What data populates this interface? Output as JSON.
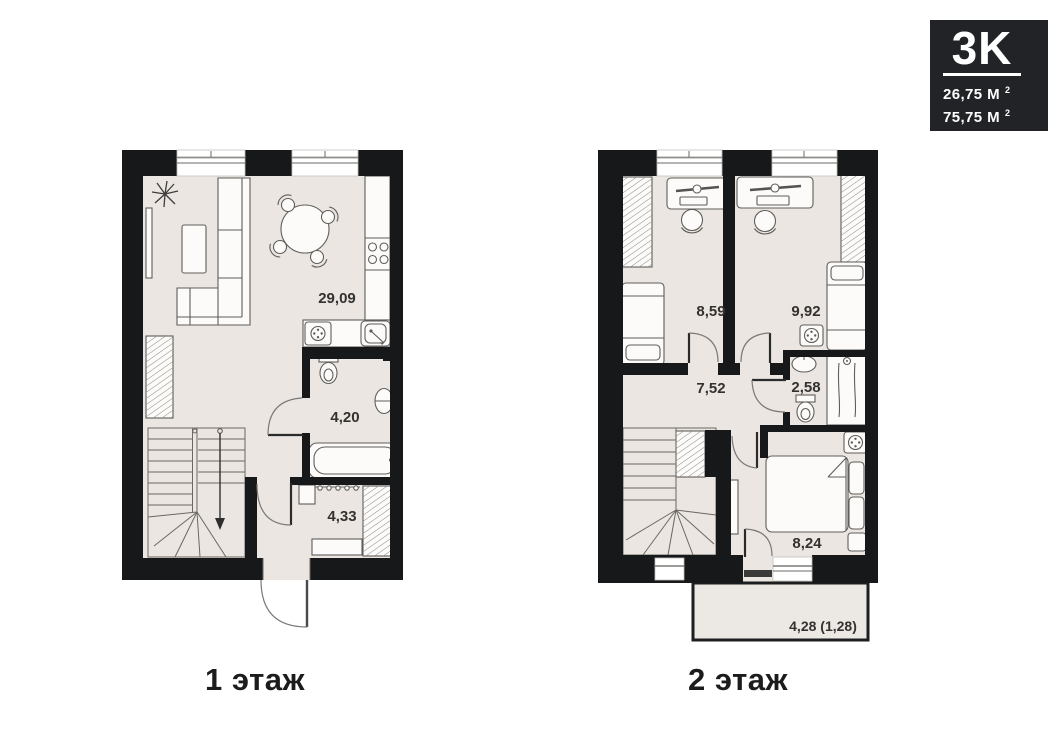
{
  "badge": {
    "type_label": "3K",
    "areas": [
      {
        "value": "26,75 М",
        "sup": "2"
      },
      {
        "value": "75,75 М",
        "sup": "2"
      }
    ]
  },
  "floors": [
    {
      "caption": "1 этаж",
      "rooms": [
        {
          "name": "kitchen-living-room",
          "area": "29,09"
        },
        {
          "name": "bathroom",
          "area": "4,20"
        },
        {
          "name": "hallway",
          "area": "4,33"
        }
      ]
    },
    {
      "caption": "2 этаж",
      "rooms": [
        {
          "name": "bedroom-1",
          "area": "8,59"
        },
        {
          "name": "bedroom-2",
          "area": "9,92"
        },
        {
          "name": "hall",
          "area": "7,52"
        },
        {
          "name": "bathroom",
          "area": "2,58"
        },
        {
          "name": "bedroom-3",
          "area": "8,24"
        },
        {
          "name": "balcony",
          "area": "4,28 (1,28)"
        }
      ]
    }
  ],
  "colors": {
    "wall": "#17181a",
    "floor_fill": "#ebe6e1",
    "badge_background": "#222326",
    "badge_text": "#ffffff",
    "label_text": "#343230"
  }
}
